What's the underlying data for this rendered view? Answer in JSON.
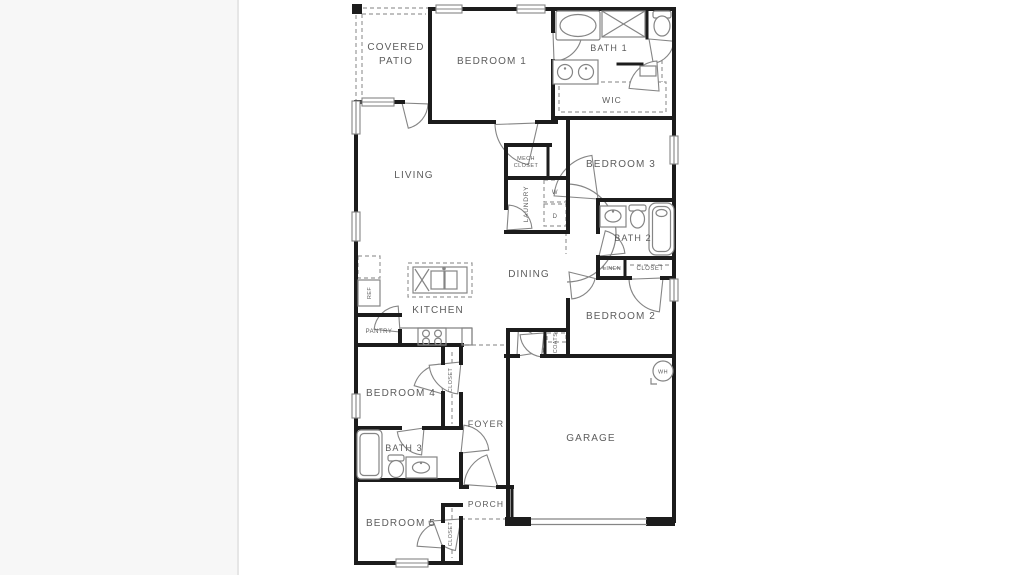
{
  "colors": {
    "background_band": "#f7f7f7",
    "panel": "#ffffff",
    "divider": "#e6e6e6",
    "wall": "#1c1c1c",
    "thin_line": "#858585",
    "dashed_line": "#9a9a9a",
    "label_text": "#5d5d5d"
  },
  "floor_plan": {
    "labels": {
      "covered_patio_line1": "COVERED",
      "covered_patio_line2": "PATIO",
      "bedroom1": "BEDROOM 1",
      "bath1": "BATH 1",
      "wic": "WIC",
      "living": "LIVING",
      "bedroom3": "BEDROOM 3",
      "mech_closet_line1": "MECH",
      "mech_closet_line2": "CLOSET",
      "laundry": "LAUNDRY",
      "bath2": "BATH 2",
      "linen": "LINEN",
      "closet_bedroom2": "CLOSET",
      "dining": "DINING",
      "kitchen": "KITCHEN",
      "ref": "REF",
      "pantry": "PANTRY",
      "bedroom2": "BEDROOM 2",
      "coats": "COATS",
      "garage": "GARAGE",
      "bedroom4": "BEDROOM 4",
      "closet_bedroom4": "CLOSET",
      "foyer": "FOYER",
      "bath3": "BATH 3",
      "bedroom5": "BEDROOM 5",
      "closet_bedroom5": "CLOSET",
      "porch": "PORCH"
    },
    "appliances": {
      "washer": "W",
      "dryer": "D",
      "water_heater": "WH"
    }
  }
}
